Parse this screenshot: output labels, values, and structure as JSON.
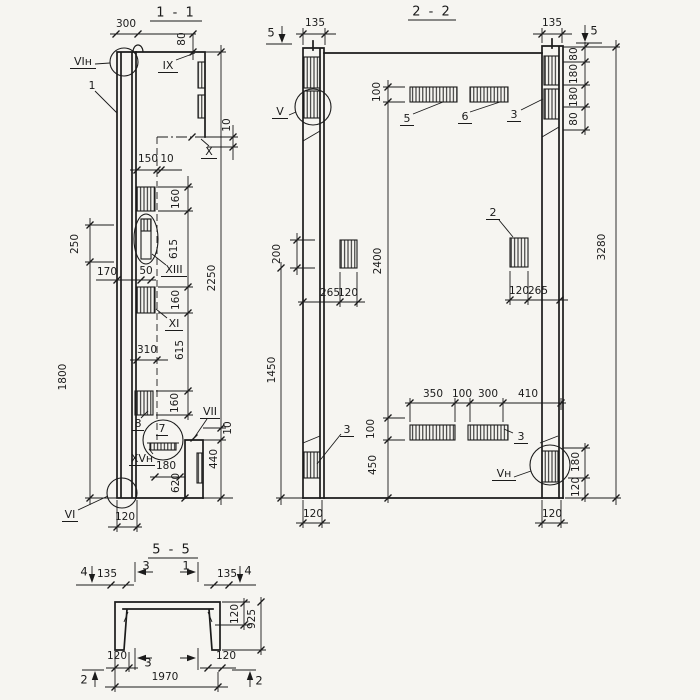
{
  "drawing": {
    "paper_color": "#f6f5f1",
    "ink_color": "#1b1b1b",
    "type": "structural panel sections"
  },
  "sections": {
    "s11": {
      "title": "1 - 1",
      "texts": [
        {
          "t": "300",
          "x": 126,
          "y": 24
        },
        {
          "t": "80",
          "x": 182,
          "y": 39,
          "r": -90
        },
        {
          "t": "10",
          "x": 227,
          "y": 125,
          "r": -90
        },
        {
          "t": "150",
          "x": 148,
          "y": 159
        },
        {
          "t": "10",
          "x": 167,
          "y": 159
        },
        {
          "t": "160",
          "x": 176,
          "y": 199,
          "r": -90
        },
        {
          "t": "615",
          "x": 174,
          "y": 249,
          "r": -90
        },
        {
          "t": "160",
          "x": 176,
          "y": 300,
          "r": -90
        },
        {
          "t": "615",
          "x": 180,
          "y": 350,
          "r": -90
        },
        {
          "t": "160",
          "x": 175,
          "y": 403,
          "r": -90
        },
        {
          "t": "2250",
          "x": 212,
          "y": 278,
          "r": -90
        },
        {
          "t": "250",
          "x": 75,
          "y": 244,
          "r": -90
        },
        {
          "t": "1800",
          "x": 63,
          "y": 377,
          "r": -90
        },
        {
          "t": "170",
          "x": 107,
          "y": 272
        },
        {
          "t": "50",
          "x": 146,
          "y": 271
        },
        {
          "t": "310",
          "x": 147,
          "y": 350
        },
        {
          "t": "180",
          "x": 166,
          "y": 466
        },
        {
          "t": "620",
          "x": 176,
          "y": 483,
          "r": -90
        },
        {
          "t": "10",
          "x": 228,
          "y": 428,
          "r": -90
        },
        {
          "t": "440",
          "x": 214,
          "y": 459,
          "r": -90
        },
        {
          "t": "120",
          "x": 125,
          "y": 517
        },
        {
          "t": "VIн",
          "x": 83,
          "y": 62,
          "u": 26,
          "k": "label"
        },
        {
          "t": "1",
          "x": 92,
          "y": 86,
          "k": "label"
        },
        {
          "t": "IX",
          "x": 168,
          "y": 66,
          "u": 20,
          "k": "label"
        },
        {
          "t": "X",
          "x": 209,
          "y": 152,
          "u": 16,
          "k": "label"
        },
        {
          "t": "XIII",
          "x": 174,
          "y": 270,
          "u": 26,
          "k": "label"
        },
        {
          "t": "XI",
          "x": 174,
          "y": 324,
          "u": 18,
          "k": "label"
        },
        {
          "t": "8",
          "x": 138,
          "y": 424,
          "u": 12,
          "k": "label"
        },
        {
          "t": "7",
          "x": 162,
          "y": 429,
          "u": 12,
          "k": "label"
        },
        {
          "t": "VII",
          "x": 210,
          "y": 412,
          "u": 20,
          "k": "label"
        },
        {
          "t": "XVн",
          "x": 142,
          "y": 459,
          "u": 26,
          "k": "label"
        },
        {
          "t": "VI",
          "x": 70,
          "y": 515,
          "u": 16,
          "k": "label"
        }
      ]
    },
    "s22": {
      "title": "2 - 2",
      "texts": [
        {
          "t": "135",
          "x": 315,
          "y": 23
        },
        {
          "t": "135",
          "x": 552,
          "y": 23
        },
        {
          "t": "80",
          "x": 574,
          "y": 54,
          "r": -90
        },
        {
          "t": "180",
          "x": 574,
          "y": 74,
          "r": -90
        },
        {
          "t": "180",
          "x": 574,
          "y": 97,
          "r": -90
        },
        {
          "t": "80",
          "x": 574,
          "y": 119,
          "r": -90
        },
        {
          "t": "3280",
          "x": 602,
          "y": 247,
          "r": -90
        },
        {
          "t": "100",
          "x": 377,
          "y": 92,
          "r": -90
        },
        {
          "t": "2400",
          "x": 378,
          "y": 261,
          "r": -90
        },
        {
          "t": "200",
          "x": 277,
          "y": 254,
          "r": -90
        },
        {
          "t": "1450",
          "x": 272,
          "y": 370,
          "r": -90
        },
        {
          "t": "265",
          "x": 330,
          "y": 293
        },
        {
          "t": "120",
          "x": 348,
          "y": 293
        },
        {
          "t": "120",
          "x": 519,
          "y": 291
        },
        {
          "t": "265",
          "x": 538,
          "y": 291
        },
        {
          "t": "350",
          "x": 433,
          "y": 394
        },
        {
          "t": "100",
          "x": 462,
          "y": 394
        },
        {
          "t": "300",
          "x": 488,
          "y": 394
        },
        {
          "t": "410",
          "x": 528,
          "y": 394
        },
        {
          "t": "100",
          "x": 371,
          "y": 429,
          "r": -90
        },
        {
          "t": "450",
          "x": 373,
          "y": 465,
          "r": -90
        },
        {
          "t": "180",
          "x": 576,
          "y": 462,
          "r": -90
        },
        {
          "t": "120",
          "x": 576,
          "y": 487,
          "r": -90
        },
        {
          "t": "120",
          "x": 313,
          "y": 514
        },
        {
          "t": "120",
          "x": 552,
          "y": 514
        },
        {
          "t": "5",
          "x": 271,
          "y": 33,
          "k": "mark"
        },
        {
          "t": "5",
          "x": 594,
          "y": 31,
          "k": "mark"
        },
        {
          "t": "V",
          "x": 280,
          "y": 112,
          "u": 16,
          "k": "label"
        },
        {
          "t": "3",
          "x": 514,
          "y": 115,
          "u": 14,
          "k": "label"
        },
        {
          "t": "5",
          "x": 407,
          "y": 119,
          "u": 14,
          "k": "label"
        },
        {
          "t": "6",
          "x": 465,
          "y": 117,
          "u": 14,
          "k": "label"
        },
        {
          "t": "2",
          "x": 493,
          "y": 213,
          "u": 14,
          "k": "label"
        },
        {
          "t": "3",
          "x": 347,
          "y": 430,
          "u": 14,
          "k": "label"
        },
        {
          "t": "3",
          "x": 521,
          "y": 437,
          "u": 14,
          "k": "label"
        },
        {
          "t": "Vн",
          "x": 504,
          "y": 474,
          "u": 24,
          "k": "label"
        }
      ]
    },
    "s55": {
      "title": "5 - 5",
      "texts": [
        {
          "t": "135",
          "x": 107,
          "y": 574
        },
        {
          "t": "135",
          "x": 227,
          "y": 574
        },
        {
          "t": "120",
          "x": 235,
          "y": 614,
          "r": -90
        },
        {
          "t": "925",
          "x": 252,
          "y": 619,
          "r": -90
        },
        {
          "t": "120",
          "x": 117,
          "y": 656
        },
        {
          "t": "120",
          "x": 226,
          "y": 656
        },
        {
          "t": "1970",
          "x": 165,
          "y": 677
        },
        {
          "t": "4",
          "x": 84,
          "y": 572,
          "k": "mark"
        },
        {
          "t": "4",
          "x": 248,
          "y": 571,
          "k": "mark"
        },
        {
          "t": "3",
          "x": 146,
          "y": 566,
          "k": "mark"
        },
        {
          "t": "1",
          "x": 186,
          "y": 566,
          "k": "mark"
        },
        {
          "t": "3",
          "x": 148,
          "y": 663,
          "k": "mark"
        },
        {
          "t": "2",
          "x": 84,
          "y": 680,
          "k": "mark"
        },
        {
          "t": "2",
          "x": 259,
          "y": 681,
          "k": "mark"
        }
      ]
    }
  }
}
